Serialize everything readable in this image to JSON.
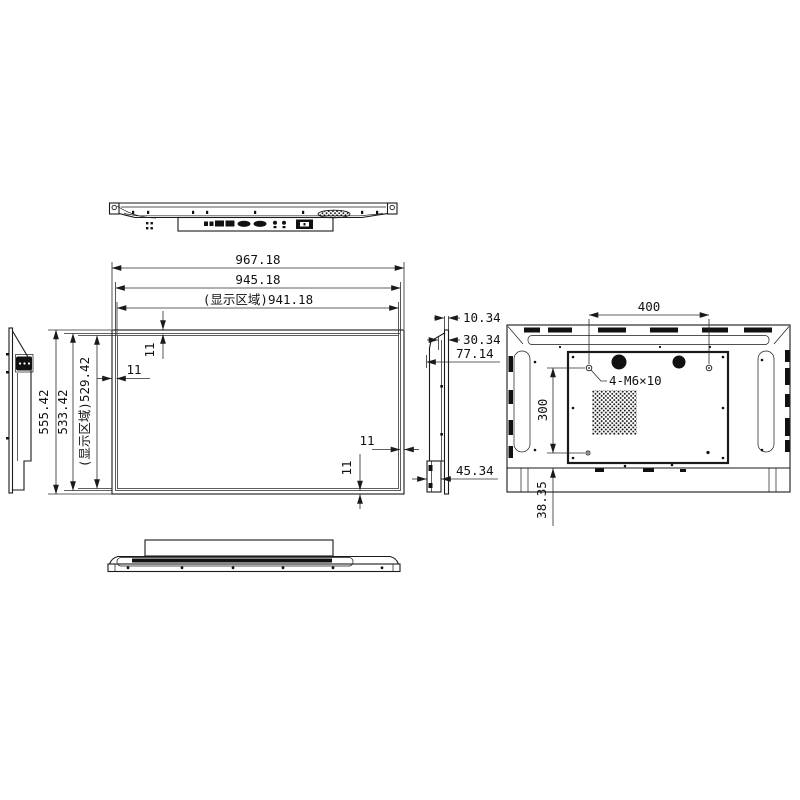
{
  "page": {
    "background": "#ffffff",
    "line_color": "#1a1a1a"
  },
  "front_view": {
    "dim_width_outer": "967.18",
    "dim_width_frame": "945.18",
    "dim_width_display": "(显示区域)941.18",
    "dim_height_outer": "555.42",
    "dim_height_frame": "533.42",
    "dim_height_display": "(显示区域)529.42",
    "bezel_top": "11",
    "bezel_left": "11",
    "bezel_right": "11",
    "bezel_bottom": "11"
  },
  "side_view": {
    "dim_glass_depth": "10.34",
    "dim_front_depth": "30.34",
    "dim_total_depth": "77.14",
    "dim_bottom_box_depth": "45.34"
  },
  "rear_view": {
    "dim_vesa_width": "400",
    "dim_vesa_height": "300",
    "dim_bottom_offset": "38.35",
    "label_mount_holes": "4-M6×10"
  }
}
